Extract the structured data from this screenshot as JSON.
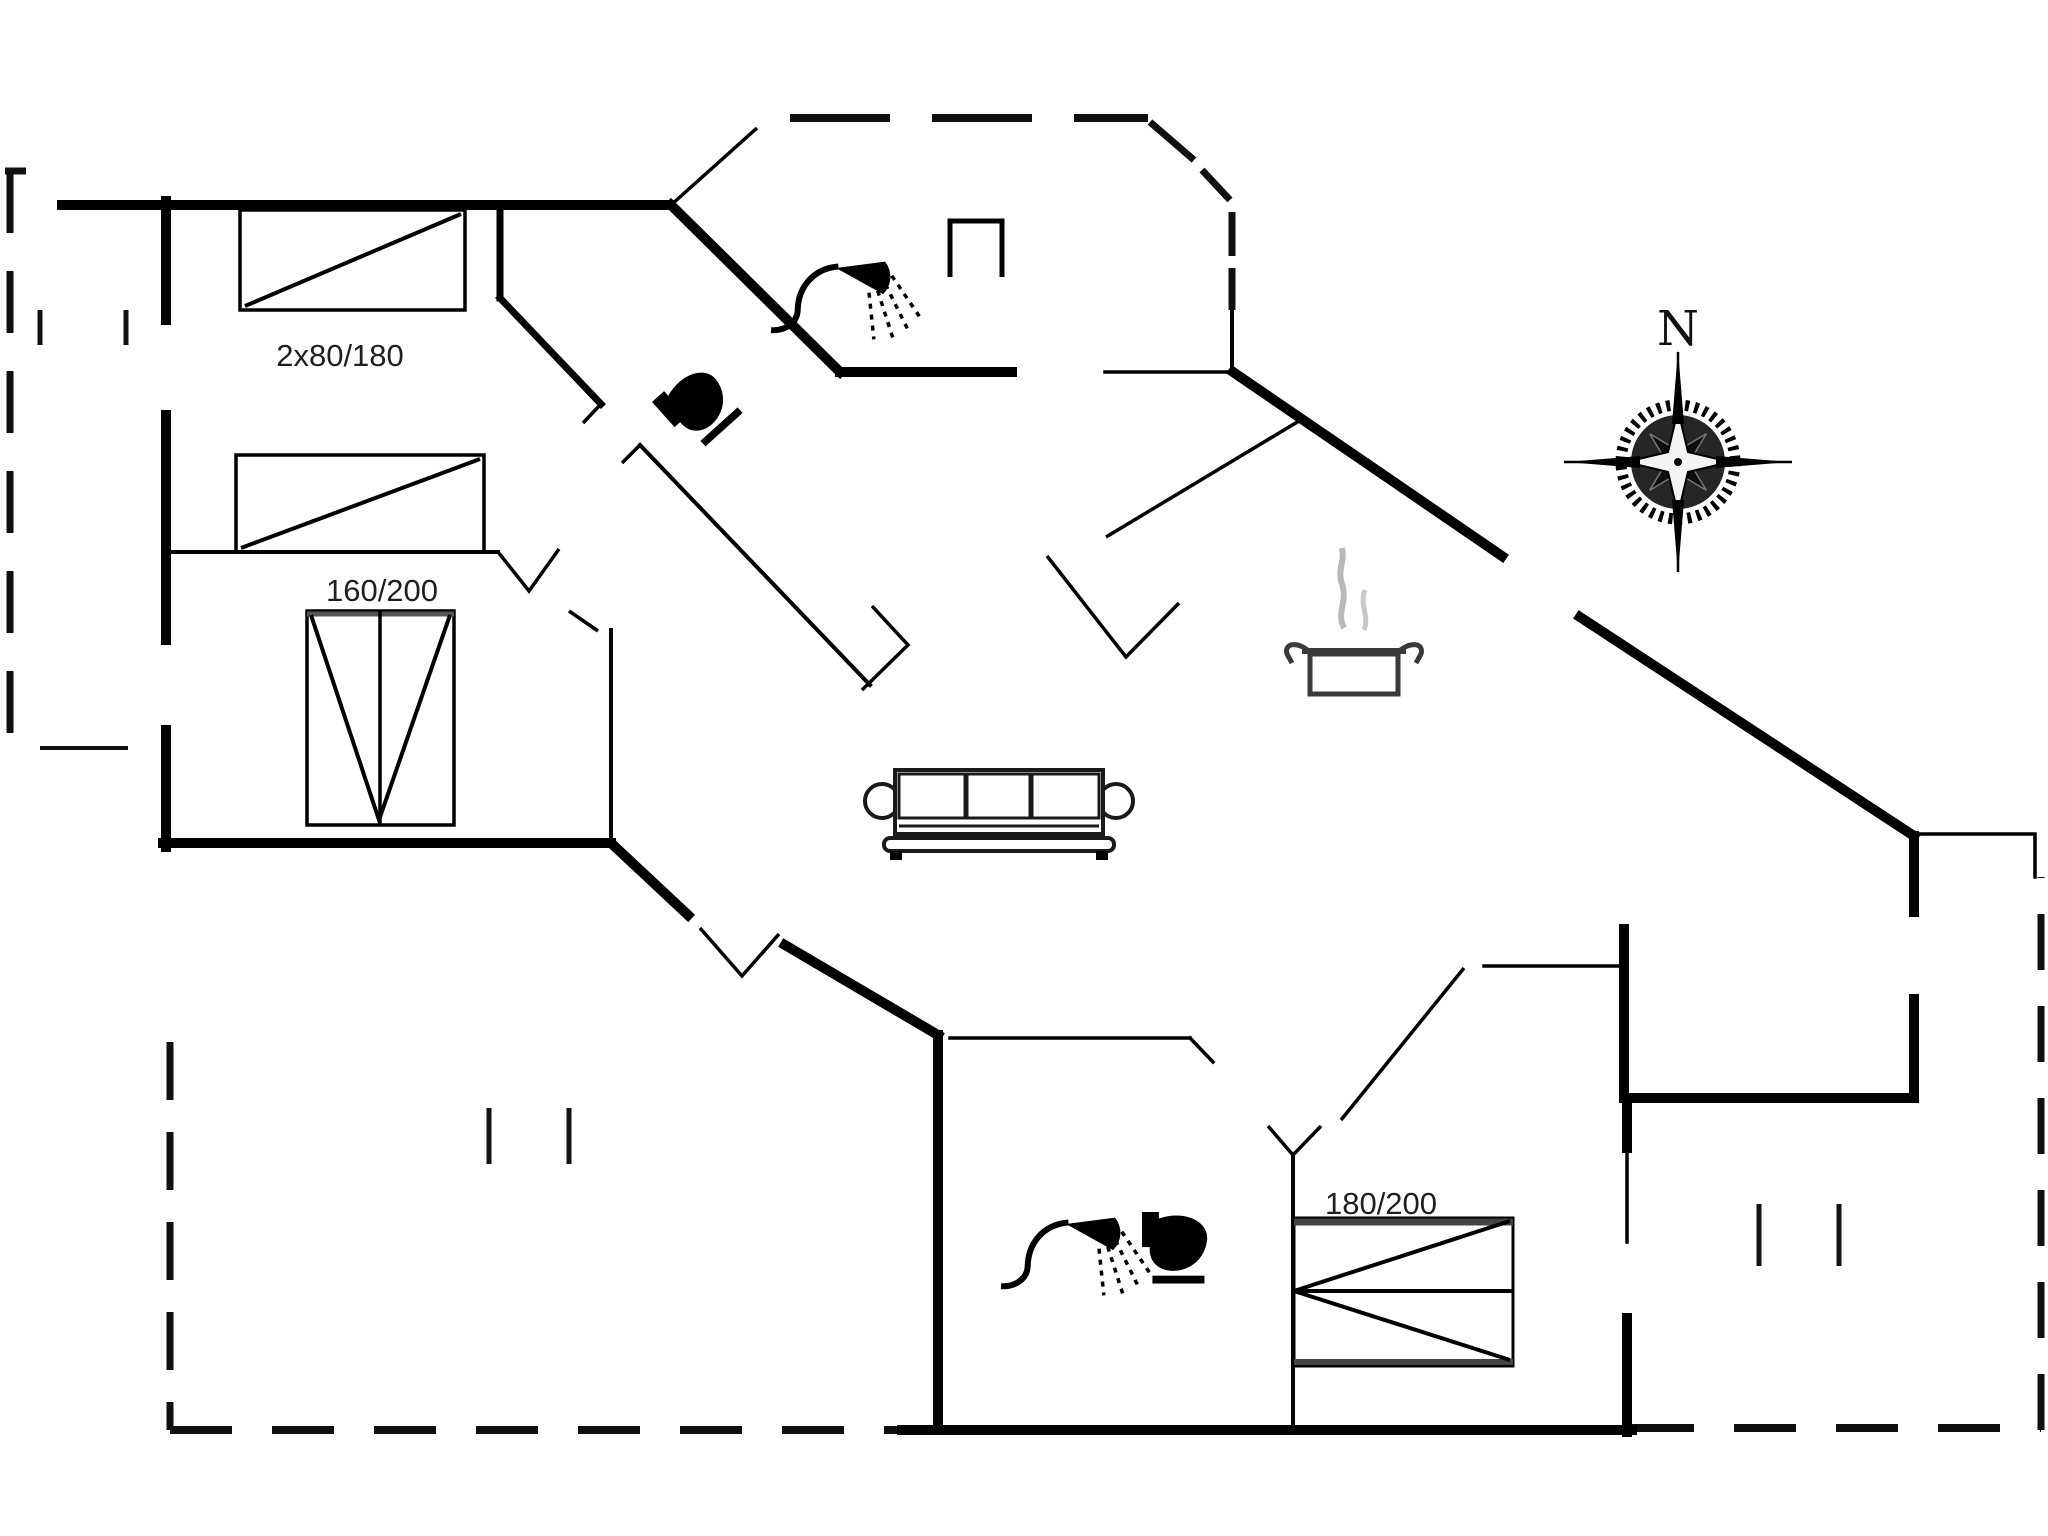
{
  "document": {
    "kind": "architectural-floor-plan",
    "background": "#ffffff",
    "ink": "#000000"
  },
  "labels": {
    "bed_top_left": "2x80/180",
    "bed_mid_left": "160/200",
    "bed_bottom_right": "180/200",
    "compass_north": "N"
  },
  "colors": {
    "wall": "#000000",
    "background": "#ffffff",
    "steam": "#b9b9b9",
    "text": "#1f1f1f",
    "bed_edge": "#444444"
  },
  "icons": [
    {
      "name": "double-bed-icon",
      "label": "2x80/180",
      "area": "top-left bedroom"
    },
    {
      "name": "single-bed-icon",
      "label": "",
      "area": "left middle bedroom"
    },
    {
      "name": "double-bed-icon",
      "label": "160/200",
      "area": "left lower bedroom"
    },
    {
      "name": "double-bed-icon",
      "label": "180/200",
      "area": "bottom right bedroom"
    },
    {
      "name": "shower-icon",
      "area": "upper bathroom"
    },
    {
      "name": "toilet-icon",
      "area": "upper bathroom"
    },
    {
      "name": "shower-icon",
      "area": "lower bathroom"
    },
    {
      "name": "toilet-icon",
      "area": "lower bathroom"
    },
    {
      "name": "sofa-icon",
      "area": "living room"
    },
    {
      "name": "cooking-pot-icon",
      "area": "kitchen"
    },
    {
      "name": "fireplace-icon",
      "area": "hall"
    },
    {
      "name": "compass-rose-icon",
      "label": "N",
      "area": "top right"
    }
  ]
}
